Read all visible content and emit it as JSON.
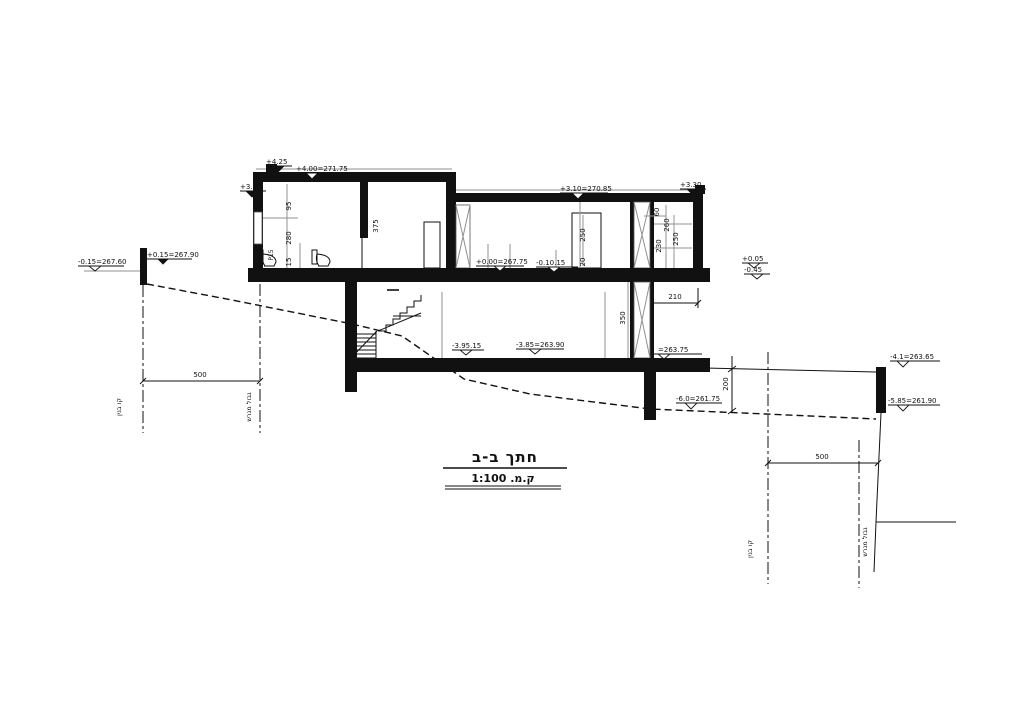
{
  "title": {
    "text": "חתך ב-ב",
    "scale": "ק.מ. 1:100"
  },
  "levels": {
    "lv_425": "+4.25",
    "lv_400": "+4.00=271.75",
    "lv_320": "+3.20",
    "lv_310": "+3.10=270.85",
    "lv_330": "+3.30",
    "lv_p015": "+0.15=267.90",
    "lv_m015": "-0.15=267.60",
    "lv_000": "+0.00=267.75",
    "lv_m010": "-0.10.15",
    "lv_p005": "+0.05",
    "lv_m045": "-0.45",
    "lv_m395": "-3.95.15",
    "lv_m385": "-3.85=263.90",
    "lv_26375": "=263.75",
    "lv_m41": "-4.1=263.65",
    "lv_m585": "-5.85=261.90",
    "lv_m60": "-6.0=261.75"
  },
  "dims": {
    "d95": "95",
    "d280": "280",
    "d15": "15",
    "dp15": "P15",
    "d375": "375",
    "d250_mid": "250",
    "d20": "20",
    "d60": "60",
    "d260": "260",
    "d250_right": "250",
    "d230": "230",
    "d350": "350",
    "d210": "210",
    "d200": "200",
    "d500_left": "500",
    "d500_right": "500"
  },
  "site": {
    "building_line_left": "קו בנין",
    "plot_boundary_left": "גבול מגרש",
    "building_line_right": "קו בנין",
    "plot_boundary_right": "גבול מגרש"
  },
  "colors": {
    "ink": "#111111",
    "gray": "#909090",
    "paper": "#ffffff"
  }
}
